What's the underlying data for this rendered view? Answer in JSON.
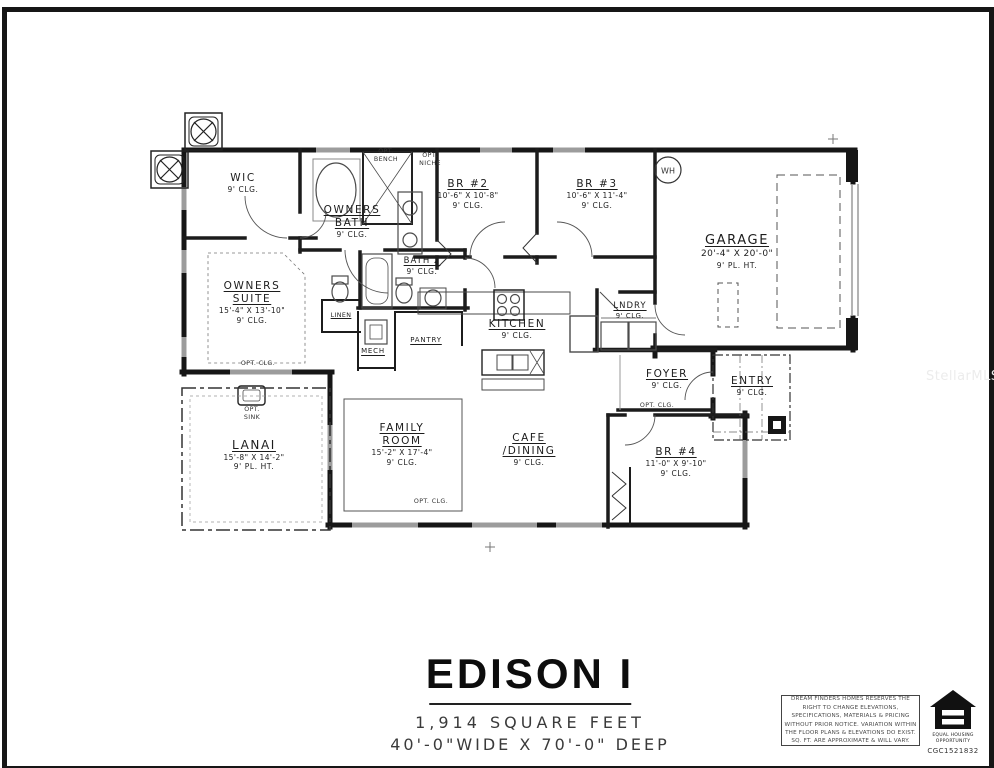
{
  "watermark": "StellarMLS",
  "rooms": {
    "wic": {
      "name": "WIC",
      "clg": "9' CLG."
    },
    "owners_bath": {
      "name1": "OWNERS",
      "name2": "BATH",
      "clg": "9' CLG."
    },
    "br2": {
      "name": "BR #2",
      "dims": "10'-6\" X 10'-8\"",
      "clg": "9' CLG."
    },
    "br3": {
      "name": "BR #3",
      "dims": "10'-6\" X 11'-4\"",
      "clg": "9' CLG."
    },
    "wh": "WH",
    "garage": {
      "name": "GARAGE",
      "dims": "20'-4\" X 20'-0\"",
      "clg": "9' PL. HT."
    },
    "owners_suite": {
      "name1": "OWNERS",
      "name2": "SUITE",
      "dims": "15'-4\" X 13'-10\"",
      "clg": "9' CLG.",
      "opt": "OPT. CLG."
    },
    "bath2": {
      "name": "BATH 2",
      "clg": "9' CLG."
    },
    "linen": "LINEN",
    "mech": "MECH",
    "pantry": "PANTRY",
    "kitchen": {
      "name": "KITCHEN",
      "clg": "9' CLG."
    },
    "lndry": {
      "name": "LNDRY",
      "clg": "9' CLG."
    },
    "foyer": {
      "name": "FOYER",
      "clg": "9' CLG.",
      "opt": "OPT. CLG."
    },
    "entry": {
      "name": "ENTRY",
      "clg": "9' CLG."
    },
    "lanai": {
      "name": "LANAI",
      "dims": "15'-8\" X 14'-2\"",
      "clg": "9' PL. HT."
    },
    "family_room": {
      "name1": "FAMILY",
      "name2": "ROOM",
      "dims": "15'-2\" X 17'-4\"",
      "clg": "9' CLG.",
      "opt": "OPT. CLG."
    },
    "cafe": {
      "name1": "CAFE",
      "name2": "/DINING",
      "clg": "9' CLG."
    },
    "br4": {
      "name": "BR #4",
      "dims": "11'-0\" X 9'-10\"",
      "clg": "9' CLG."
    }
  },
  "annotations": {
    "opt_bench1": "OPT.",
    "opt_bench2": "BENCH",
    "opt_niche1": "OPT.",
    "opt_niche2": "NICHE",
    "opt_sink1": "OPT.",
    "opt_sink2": "SINK"
  },
  "title": {
    "name": "EDISON I",
    "sqft": "1,914 SQUARE FEET",
    "dims": "40'-0\"WIDE X 70'-0\" DEEP"
  },
  "legal": {
    "disclaimer": "DREAM FINDERS HOMES RESERVES THE RIGHT TO CHANGE ELEVATIONS, SPECIFICATIONS, MATERIALS & PRICING WITHOUT PRIOR NOTICE. VARIATION WITHIN THE FLOOR PLANS & ELEVATIONS DO EXIST. SQ. FT. ARE APPROXIMATE & WILL VARY.",
    "eho_line1": "EQUAL HOUSING",
    "eho_line2": "OPPORTUNITY",
    "license": "CGC1521832"
  },
  "colors": {
    "wall": "#161616",
    "window": "#9c9c9c",
    "watermark": "#ececec"
  }
}
